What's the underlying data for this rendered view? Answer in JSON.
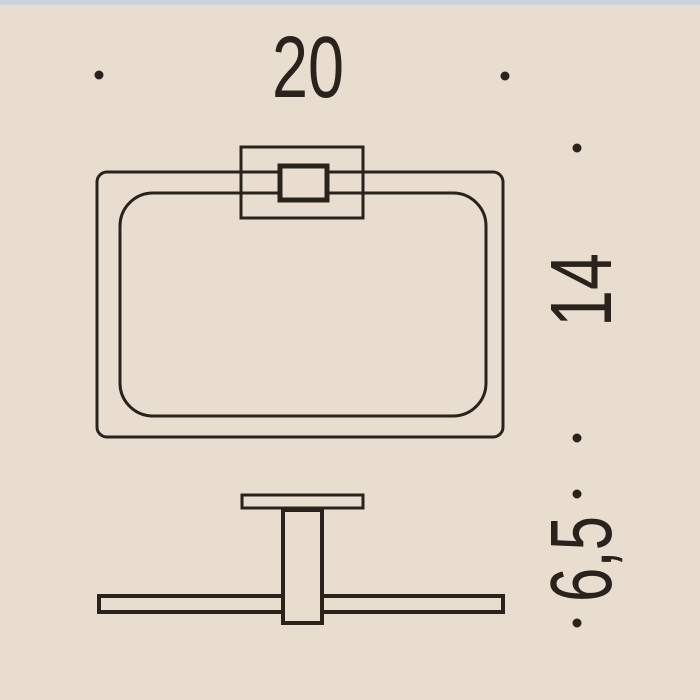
{
  "colors": {
    "background": "#e8ddce",
    "top_bar": "#cbd2dd",
    "ink": "#2a231d"
  },
  "dimension_labels": {
    "width": "20",
    "height": "14",
    "depth": "6,5"
  }
}
